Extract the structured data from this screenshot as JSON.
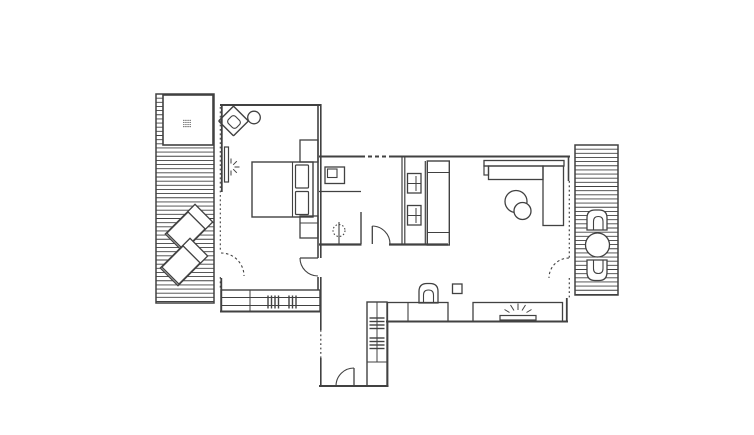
{
  "meta": {
    "canvas_w": 754,
    "canvas_h": 435,
    "bg": "#ffffff",
    "ink": "#414141"
  },
  "plan": {
    "stripes": [
      {
        "n": "west-deck-decking",
        "x": 156,
        "y": 94,
        "w": 58,
        "h": 209,
        "gap": 4.15
      },
      {
        "n": "east-deck-decking",
        "x": 575,
        "y": 145,
        "w": 43,
        "h": 150,
        "gap": 4.15
      }
    ],
    "rects": [
      {
        "n": "west-deck-border",
        "x": 156,
        "y": 94,
        "w": 58,
        "h": 209,
        "sw": 1.5
      },
      {
        "n": "east-deck-border",
        "x": 575,
        "y": 145,
        "w": 43,
        "h": 150,
        "sw": 1.5
      },
      {
        "n": "hot-tub",
        "x": 163,
        "y": 95,
        "w": 50,
        "h": 50,
        "sw": 1.6,
        "f": "#ffffff"
      },
      {
        "n": "bed-platform",
        "x": 252,
        "y": 162,
        "w": 61,
        "h": 55,
        "sw": 1.4
      },
      {
        "n": "bed-pillow",
        "x": 295.5,
        "y": 165,
        "w": 13,
        "h": 23,
        "rx": 1,
        "sw": 1.2
      },
      {
        "n": "bed-pillow",
        "x": 295.5,
        "y": 191.5,
        "w": 13,
        "h": 23,
        "rx": 1,
        "sw": 1.2
      },
      {
        "n": "nightstand-north",
        "x": 300,
        "y": 140,
        "w": 18,
        "h": 22,
        "sw": 1.3
      },
      {
        "n": "nightstand-south",
        "x": 300,
        "y": 216,
        "w": 18,
        "h": 22,
        "sw": 1.3
      },
      {
        "n": "mirror-panel",
        "x": 224.5,
        "y": 147,
        "w": 4,
        "h": 35,
        "sw": 1.2
      },
      {
        "n": "bedroom-wardrobe",
        "x": 221,
        "y": 290,
        "w": 99,
        "h": 21.5,
        "sw": 1.4
      },
      {
        "n": "bath-sink-outer",
        "x": 325,
        "y": 167,
        "w": 19.5,
        "h": 16.5,
        "sw": 1.3
      },
      {
        "n": "bath-sink-basin",
        "x": 327.5,
        "y": 169,
        "w": 9.5,
        "h": 8.5,
        "sw": 1.1
      },
      {
        "n": "utility-fixture",
        "x": 407.5,
        "y": 173.5,
        "w": 13.5,
        "h": 19.5,
        "sw": 1.3
      },
      {
        "n": "utility-fixture",
        "x": 407.5,
        "y": 205.5,
        "w": 13.5,
        "h": 19.5,
        "sw": 1.3
      },
      {
        "n": "tall-cabinet",
        "x": 427.3,
        "y": 161,
        "w": 22,
        "h": 84,
        "sw": 1.4
      },
      {
        "n": "sofa-back",
        "x": 484,
        "y": 160.5,
        "w": 80,
        "h": 5.5,
        "sw": 1.3
      },
      {
        "n": "sofa-seat",
        "x": 488.5,
        "y": 166,
        "w": 54.5,
        "h": 13.5,
        "sw": 1.3
      },
      {
        "n": "sofa-chaise",
        "x": 543,
        "y": 166,
        "w": 20.5,
        "h": 59.5,
        "sw": 1.3
      },
      {
        "n": "sofa-armrest",
        "x": 484,
        "y": 166,
        "w": 4.5,
        "h": 9,
        "sw": 1.2
      },
      {
        "n": "stool",
        "x": 452.5,
        "y": 284,
        "w": 9.5,
        "h": 9.5,
        "sw": 1.3
      },
      {
        "n": "kitchen-counter-west",
        "x": 387.5,
        "y": 302.5,
        "w": 60.5,
        "h": 19,
        "sw": 1.3
      },
      {
        "n": "kitchen-counter-east",
        "x": 473,
        "y": 302.5,
        "w": 89.5,
        "h": 19,
        "sw": 1.3
      },
      {
        "n": "cooktop-strip",
        "x": 500,
        "y": 315.5,
        "w": 36,
        "h": 4.5,
        "sw": 1.2
      },
      {
        "n": "entry-closet",
        "x": 367,
        "y": 302,
        "w": 20,
        "h": 84,
        "sw": 1.4
      }
    ],
    "rotrects": [
      {
        "n": "lounge-chair-frame",
        "cx": 189,
        "cy": 228,
        "w": 25,
        "h": 42,
        "a": 45
      },
      {
        "n": "lounge-chair-body",
        "cx": 186,
        "cy": 231,
        "w": 24,
        "h": 30,
        "a": 45
      },
      {
        "n": "lounge-chair-frame",
        "cx": 184,
        "cy": 262,
        "w": 25,
        "h": 42,
        "a": 45
      },
      {
        "n": "lounge-chair-body",
        "cx": 181,
        "cy": 265,
        "w": 24,
        "h": 30,
        "a": 45
      },
      {
        "n": "armchair-outer",
        "cx": 233.5,
        "cy": 121,
        "w": 21,
        "h": 21,
        "a": 45,
        "rx": 1,
        "sw": 1.4
      },
      {
        "n": "armchair-seat",
        "cx": 234,
        "cy": 122,
        "w": 11.5,
        "h": 10,
        "a": 45,
        "rx": 3,
        "sw": 1.1
      }
    ],
    "circles": [
      {
        "n": "side-table",
        "cx": 254,
        "cy": 117.5,
        "r": 6.3
      },
      {
        "n": "patio-table",
        "cx": 597.5,
        "cy": 245,
        "r": 12,
        "f": "#ffffff"
      },
      {
        "n": "coffee-table-large",
        "cx": 516,
        "cy": 201.5,
        "r": 11,
        "f": "#ffffff"
      },
      {
        "n": "coffee-table-small",
        "cx": 522.5,
        "cy": 211,
        "r": 8.5,
        "f": "#ffffff"
      },
      {
        "n": "shower-head",
        "cx": 339,
        "cy": 230.5,
        "r": 6,
        "dash": "1.5,2",
        "sw": 1.1
      }
    ],
    "paths": [
      {
        "n": "patio-chair-north",
        "d": "M587 230 L587 218 Q587 210 595 210 L599 210 Q607 210 607 218 L607 230 Z",
        "f": "#ffffff",
        "sw": 1.3
      },
      {
        "n": "patio-chair-north-seat",
        "d": "M593.5 230 L593.5 221.5 Q593.5 216.5 598.3 216.5 Q603 216.5 603 221.5 L603 230",
        "sw": 1.1
      },
      {
        "n": "patio-chair-south",
        "d": "M587 260 L587 272 Q587 280.5 595 280.5 L599 280.5 Q607 280.5 607 272 L607 260 Z",
        "f": "#ffffff",
        "sw": 1.3
      },
      {
        "n": "patio-chair-south-seat",
        "d": "M593.5 260 L593.5 268.5 Q593.5 273.5 598.3 273.5 Q603 273.5 603 268.5 L603 260",
        "sw": 1.1
      },
      {
        "n": "desk-chair",
        "d": "M419 303 L419 291.5 Q419 283.5 427 283.5 L430 283.5 Q438 283.5 438 291.5 L438 303 Z",
        "sw": 1.3
      },
      {
        "n": "desk-chair-seat",
        "d": "M423.5 303 L423.5 295 Q423.5 290 428.5 290 Q433.5 290 433.5 295 L433.5 303",
        "sw": 1.1
      },
      {
        "n": "bath-door-arc",
        "d": "M372.3 226 A18 18 0 0 1 390 244",
        "sw": 1.1
      },
      {
        "n": "bedroom-door-arc",
        "d": "M300 258 A18 18 0 0 0 318 276",
        "sw": 1.1
      },
      {
        "n": "entry-door-arc",
        "d": "M354 368 A18 18 0 0 0 336 386",
        "sw": 1.1
      },
      {
        "n": "west-deck-door-arc",
        "d": "M221 253 A23 23 0 0 1 244 276",
        "dash": "2.5,2.5",
        "sw": 1.1
      },
      {
        "n": "east-deck-door-arc",
        "d": "M569 258 A20 20 0 0 0 549 278",
        "dash": "2.5,2.5",
        "sw": 1.1
      }
    ],
    "lines": [
      {
        "n": "bedroom-north-wall",
        "x1": 220,
        "y1": 105,
        "x2": 321,
        "y2": 105,
        "sw": 2
      },
      {
        "n": "bedroom-west-wall-upper",
        "x1": 221.8,
        "y1": 104,
        "x2": 221.8,
        "y2": 192,
        "sw": 1.8
      },
      {
        "n": "bedroom-west-glass",
        "x1": 220.3,
        "y1": 107,
        "x2": 220.3,
        "y2": 252,
        "dash": "1.8,2.6",
        "sw": 1.1
      },
      {
        "n": "bedroom-west-glass",
        "x1": 220.3,
        "y1": 277,
        "x2": 220.3,
        "y2": 289,
        "dash": "1.8,2.6",
        "sw": 1.1
      },
      {
        "n": "bedroom-west-wall-lower",
        "x1": 221.3,
        "y1": 278,
        "x2": 221.3,
        "y2": 312,
        "sw": 1.8
      },
      {
        "n": "bedroom-south-wall",
        "x1": 220,
        "y1": 311.5,
        "x2": 321,
        "y2": 311.5,
        "sw": 2
      },
      {
        "n": "bedroom-east-wall",
        "x1": 318,
        "y1": 104,
        "x2": 318,
        "y2": 258,
        "sw": 1.6
      },
      {
        "n": "bedroom-east-wall",
        "x1": 318,
        "y1": 277,
        "x2": 318,
        "y2": 290,
        "sw": 1.6
      },
      {
        "n": "hall-west-wall",
        "x1": 320.8,
        "y1": 104,
        "x2": 320.8,
        "y2": 258,
        "sw": 1.6
      },
      {
        "n": "hall-west-wall",
        "x1": 320.8,
        "y1": 277,
        "x2": 320.8,
        "y2": 330,
        "sw": 1.6
      },
      {
        "n": "entry-window-dotted",
        "x1": 320.8,
        "y1": 330,
        "x2": 320.8,
        "y2": 358,
        "dash": "1.8,2.6",
        "sw": 1.2
      },
      {
        "n": "entry-west-wall",
        "x1": 320.8,
        "y1": 358,
        "x2": 320.8,
        "y2": 387,
        "sw": 1.6
      },
      {
        "n": "main-north-wall",
        "x1": 319,
        "y1": 156.5,
        "x2": 361,
        "y2": 156.5,
        "sw": 2
      },
      {
        "n": "main-north-window-dashed",
        "x1": 361,
        "y1": 156.5,
        "x2": 393,
        "y2": 156.5,
        "dash": "4,3",
        "sw": 2
      },
      {
        "n": "main-north-wall",
        "x1": 393,
        "y1": 156.5,
        "x2": 570,
        "y2": 156.5,
        "sw": 2
      },
      {
        "n": "living-east-wall-upper",
        "x1": 568.5,
        "y1": 155.5,
        "x2": 568.5,
        "y2": 181,
        "sw": 1.6
      },
      {
        "n": "living-east-glass",
        "x1": 569.3,
        "y1": 181,
        "x2": 569.3,
        "y2": 258,
        "dash": "1.8,2.6",
        "sw": 1.2
      },
      {
        "n": "living-east-glass",
        "x1": 569.3,
        "y1": 278,
        "x2": 569.3,
        "y2": 298,
        "dash": "1.8,2.6",
        "sw": 1.2
      },
      {
        "n": "living-east-wall-lower",
        "x1": 566.8,
        "y1": 298,
        "x2": 566.8,
        "y2": 322,
        "sw": 1.8
      },
      {
        "n": "living-south-wall",
        "x1": 386,
        "y1": 321.5,
        "x2": 568,
        "y2": 321.5,
        "sw": 2
      },
      {
        "n": "entry-east-wall",
        "x1": 387.5,
        "y1": 321.5,
        "x2": 387.5,
        "y2": 386,
        "sw": 1.8
      },
      {
        "n": "entry-south-wall",
        "x1": 319,
        "y1": 386,
        "x2": 388.5,
        "y2": 386,
        "sw": 2
      },
      {
        "n": "bath-south-wall",
        "x1": 319,
        "y1": 244.5,
        "x2": 361.5,
        "y2": 244.5,
        "sw": 2.2
      },
      {
        "n": "bath-south-wall",
        "x1": 389,
        "y1": 244.5,
        "x2": 448,
        "y2": 244.5,
        "sw": 2.2
      },
      {
        "n": "utility-west-wall",
        "x1": 402,
        "y1": 157,
        "x2": 402,
        "y2": 244,
        "sw": 1.2
      },
      {
        "n": "utility-west-wall",
        "x1": 404.8,
        "y1": 157,
        "x2": 404.8,
        "y2": 244,
        "sw": 1.2
      },
      {
        "n": "utility-east-wall",
        "x1": 425.3,
        "y1": 161,
        "x2": 425.3,
        "y2": 244,
        "sw": 1.2
      },
      {
        "n": "bath-counter-edge",
        "x1": 319,
        "y1": 191.5,
        "x2": 361,
        "y2": 191.5,
        "sw": 1.2
      },
      {
        "n": "bath-partition",
        "x1": 361,
        "y1": 212,
        "x2": 361,
        "y2": 244,
        "sw": 1.4
      },
      {
        "n": "shower-stem",
        "x1": 339,
        "y1": 222,
        "x2": 339,
        "y2": 244,
        "sw": 1.1
      },
      {
        "n": "bath-door-leaf",
        "x1": 372.3,
        "y1": 226,
        "x2": 372.3,
        "y2": 244,
        "sw": 1.3
      },
      {
        "n": "bedroom-door-leaf",
        "x1": 300,
        "y1": 258,
        "x2": 318,
        "y2": 258,
        "sw": 1.3
      },
      {
        "n": "entry-door-leaf",
        "x1": 354,
        "y1": 368,
        "x2": 354,
        "y2": 386,
        "sw": 1.3
      },
      {
        "n": "mattress-edge",
        "x1": 292.5,
        "y1": 162,
        "x2": 292.5,
        "y2": 217,
        "sw": 1.1
      },
      {
        "n": "nightstand-divider",
        "x1": 300,
        "y1": 223,
        "x2": 318,
        "y2": 223,
        "sw": 1.1
      },
      {
        "n": "wardrobe-shelf",
        "x1": 221,
        "y1": 297.5,
        "x2": 320,
        "y2": 297.5,
        "sw": 1
      },
      {
        "n": "wardrobe-shelf",
        "x1": 221,
        "y1": 305.5,
        "x2": 320,
        "y2": 305.5,
        "sw": 1
      },
      {
        "n": "wardrobe-divider",
        "x1": 250,
        "y1": 290,
        "x2": 250,
        "y2": 311.5,
        "sw": 1
      },
      {
        "n": "wardrobe-hanger-tick",
        "x1": 268,
        "y1": 295.5,
        "x2": 268,
        "y2": 308.5,
        "sw": 1.4
      },
      {
        "n": "wardrobe-hanger-tick",
        "x1": 271.5,
        "y1": 295.5,
        "x2": 271.5,
        "y2": 308.5,
        "sw": 1.4
      },
      {
        "n": "wardrobe-hanger-tick",
        "x1": 275,
        "y1": 295.5,
        "x2": 275,
        "y2": 308.5,
        "sw": 1.4
      },
      {
        "n": "wardrobe-hanger-tick",
        "x1": 278.5,
        "y1": 295.5,
        "x2": 278.5,
        "y2": 308.5,
        "sw": 1.4
      },
      {
        "n": "wardrobe-hanger-tick",
        "x1": 289,
        "y1": 295.5,
        "x2": 289,
        "y2": 308.5,
        "sw": 1.4
      },
      {
        "n": "wardrobe-hanger-tick",
        "x1": 292.5,
        "y1": 295.5,
        "x2": 292.5,
        "y2": 308.5,
        "sw": 1.4
      },
      {
        "n": "wardrobe-hanger-tick",
        "x1": 296,
        "y1": 295.5,
        "x2": 296,
        "y2": 308.5,
        "sw": 1.4
      },
      {
        "n": "counter-divider",
        "x1": 408,
        "y1": 302.5,
        "x2": 408,
        "y2": 321.5,
        "sw": 1.1
      },
      {
        "n": "fixture-cross-h",
        "x1": 407.5,
        "y1": 183.5,
        "x2": 421,
        "y2": 183.5,
        "sw": 1
      },
      {
        "n": "fixture-cross-v",
        "x1": 416,
        "y1": 176,
        "x2": 416,
        "y2": 191,
        "sw": 1
      },
      {
        "n": "fixture-cross-h",
        "x1": 407.5,
        "y1": 215.5,
        "x2": 421,
        "y2": 215.5,
        "sw": 1
      },
      {
        "n": "fixture-cross-v",
        "x1": 416,
        "y1": 208,
        "x2": 416,
        "y2": 223,
        "sw": 1
      },
      {
        "n": "tall-cabinet-shelf",
        "x1": 427.3,
        "y1": 172.5,
        "x2": 449.3,
        "y2": 172.5,
        "sw": 1.1
      },
      {
        "n": "tall-cabinet-shelf",
        "x1": 427.3,
        "y1": 232.5,
        "x2": 449.3,
        "y2": 232.5,
        "sw": 1.1
      },
      {
        "n": "closet-shelf",
        "x1": 367,
        "y1": 362,
        "x2": 387,
        "y2": 362,
        "sw": 1.1
      },
      {
        "n": "closet-rod",
        "x1": 377,
        "y1": 302,
        "x2": 377,
        "y2": 362,
        "sw": 1
      },
      {
        "n": "closet-hanger-tick",
        "x1": 369.5,
        "y1": 318,
        "x2": 384.5,
        "y2": 318,
        "sw": 1.4
      },
      {
        "n": "closet-hanger-tick",
        "x1": 369.5,
        "y1": 321.5,
        "x2": 384.5,
        "y2": 321.5,
        "sw": 1.4
      },
      {
        "n": "closet-hanger-tick",
        "x1": 369.5,
        "y1": 325,
        "x2": 384.5,
        "y2": 325,
        "sw": 1.4
      },
      {
        "n": "closet-hanger-tick",
        "x1": 369.5,
        "y1": 328.5,
        "x2": 384.5,
        "y2": 328.5,
        "sw": 1.4
      },
      {
        "n": "closet-hanger-tick",
        "x1": 369.5,
        "y1": 338,
        "x2": 384.5,
        "y2": 338,
        "sw": 1.4
      },
      {
        "n": "closet-hanger-tick",
        "x1": 369.5,
        "y1": 341.5,
        "x2": 384.5,
        "y2": 341.5,
        "sw": 1.4
      },
      {
        "n": "closet-hanger-tick",
        "x1": 369.5,
        "y1": 345,
        "x2": 384.5,
        "y2": 345,
        "sw": 1.4
      },
      {
        "n": "closet-hanger-tick",
        "x1": 369.5,
        "y1": 348.5,
        "x2": 384.5,
        "y2": 348.5,
        "sw": 1.4
      },
      {
        "n": "lamp-ray",
        "x1": 231,
        "y1": 163.5,
        "x2": 231,
        "y2": 158.5,
        "sw": 1
      },
      {
        "n": "lamp-ray",
        "x1": 233.2,
        "y1": 164.8,
        "x2": 236.8,
        "y2": 161.2,
        "sw": 1
      },
      {
        "n": "lamp-ray",
        "x1": 234.5,
        "y1": 167,
        "x2": 239.5,
        "y2": 167,
        "sw": 1
      },
      {
        "n": "lamp-ray",
        "x1": 233.2,
        "y1": 169.2,
        "x2": 236.8,
        "y2": 172.8,
        "sw": 1
      },
      {
        "n": "lamp-ray",
        "x1": 231,
        "y1": 170.5,
        "x2": 231,
        "y2": 175.5,
        "sw": 1
      },
      {
        "n": "cooktop-ray",
        "x1": 518,
        "y1": 303.5,
        "x2": 518,
        "y2": 310,
        "sw": 1
      },
      {
        "n": "cooktop-ray",
        "x1": 510.5,
        "y1": 305,
        "x2": 514,
        "y2": 310.5,
        "sw": 1
      },
      {
        "n": "cooktop-ray",
        "x1": 525.5,
        "y1": 305,
        "x2": 522,
        "y2": 310.5,
        "sw": 1
      },
      {
        "n": "cooktop-ray",
        "x1": 504.5,
        "y1": 309.5,
        "x2": 509.5,
        "y2": 312.5,
        "sw": 1
      },
      {
        "n": "cooktop-ray",
        "x1": 531.5,
        "y1": 309.5,
        "x2": 526.5,
        "y2": 312.5,
        "sw": 1
      }
    ],
    "dotgrids": [
      {
        "n": "hot-tub-jets",
        "cx": 187,
        "cy": 123.5,
        "cols": 4,
        "rows": 4,
        "gap": 2.1,
        "r": 0.6
      }
    ]
  }
}
